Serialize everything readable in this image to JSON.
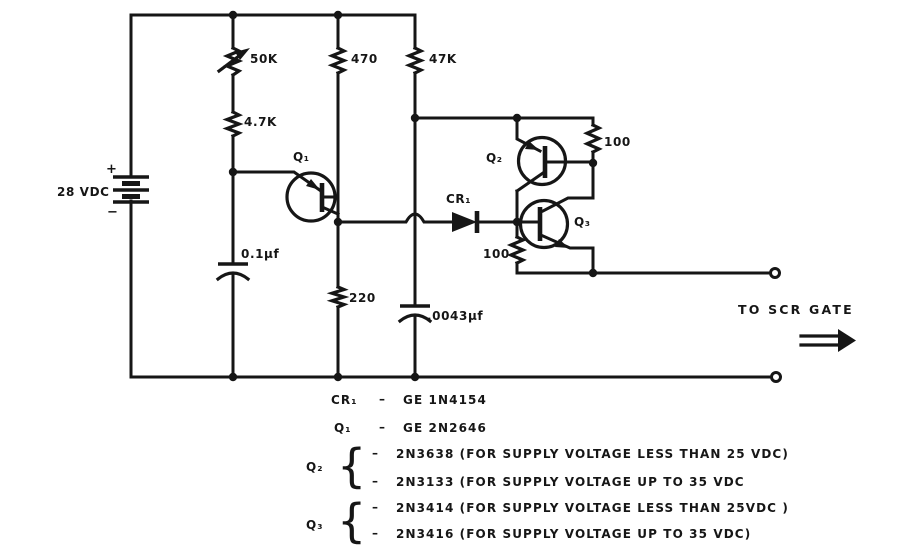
{
  "figure": {
    "background": "#ffffff",
    "ink": "#161616",
    "description_labels": {
      "supply": "28 VDC",
      "battery_plus": "+",
      "battery_minus": "−",
      "pot_50k": "50K",
      "r_4k7": "4.7K",
      "r_470": "470",
      "r_47k": "47K",
      "r_220": "220",
      "r_100_upper": "100",
      "r_100_lower": "100",
      "cap_01uf": "0.1µf",
      "cap_0043uf": ".0043µf",
      "diode_cr1": "CR₁",
      "q1": "Q₁",
      "q2": "Q₂",
      "q3": "Q₃",
      "output": "TO SCR GATE"
    },
    "parts_list": {
      "row_cr1": {
        "ref": "CR₁",
        "dash": "–",
        "desc": "GE 1N4154"
      },
      "row_q1": {
        "ref": "Q₁",
        "dash": "–",
        "desc": "GE 2N2646"
      },
      "row_q2": {
        "ref": "Q₂",
        "brace": "{",
        "opt1_dash": "–",
        "opt1": "2N3638  (FOR SUPPLY VOLTAGE LESS THAN 25 VDC)",
        "opt2_dash": "–",
        "opt2": "2N3133  (FOR SUPPLY VOLTAGE UP TO 35 VDC"
      },
      "row_q3": {
        "ref": "Q₃",
        "brace": "{",
        "opt1_dash": "–",
        "opt1": "2N3414  (FOR SUPPLY VOLTAGE LESS THAN 25VDC )",
        "opt2_dash": "–",
        "opt2": "2N3416  (FOR SUPPLY VOLTAGE UP TO 35 VDC)"
      }
    }
  }
}
